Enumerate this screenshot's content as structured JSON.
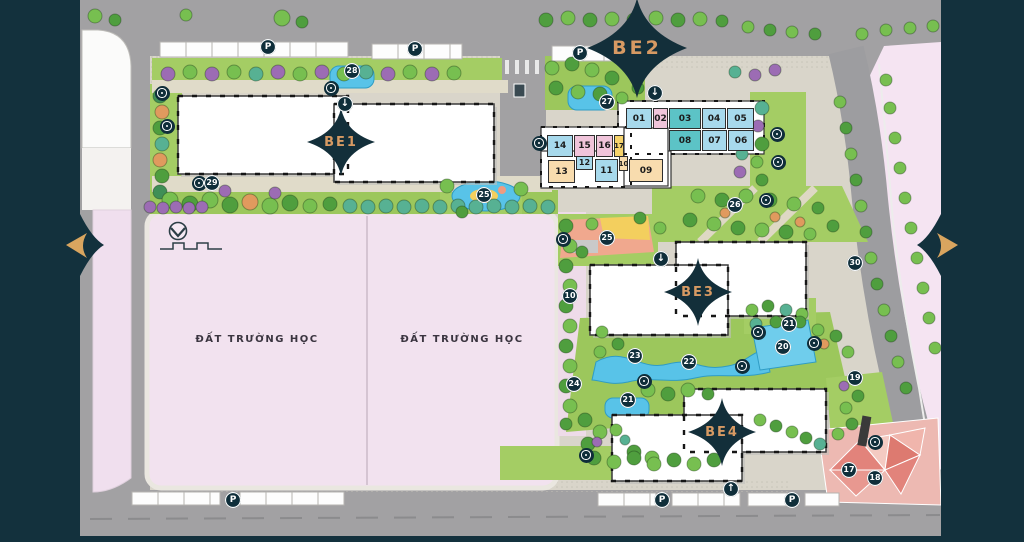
{
  "view": {
    "title": "Master plan site map"
  },
  "map": {
    "zones": [
      {
        "label": "BE1"
      },
      {
        "label": "BE2"
      },
      {
        "label": "BE3"
      },
      {
        "label": "BE4"
      }
    ],
    "school_plots": [
      {
        "label": "ĐẤT TRƯỜNG HỌC"
      },
      {
        "label": "ĐẤT TRƯỜNG HỌC"
      }
    ],
    "units": [
      {
        "label": "01",
        "category": "blue"
      },
      {
        "label": "02",
        "category": "pink"
      },
      {
        "label": "03",
        "category": "teal"
      },
      {
        "label": "04",
        "category": "blue"
      },
      {
        "label": "05",
        "category": "blue"
      },
      {
        "label": "06",
        "category": "blue"
      },
      {
        "label": "07",
        "category": "blue"
      },
      {
        "label": "08",
        "category": "teal"
      },
      {
        "label": "09",
        "category": "tan"
      },
      {
        "label": "10",
        "category": "tan"
      },
      {
        "label": "11",
        "category": "blue"
      },
      {
        "label": "12",
        "category": "blue"
      },
      {
        "label": "13",
        "category": "tan"
      },
      {
        "label": "14",
        "category": "blue"
      },
      {
        "label": "15",
        "category": "pink"
      },
      {
        "label": "16",
        "category": "pink"
      },
      {
        "label": "17",
        "category": "yellow"
      }
    ],
    "amenity_markers": [
      {
        "label": "27"
      },
      {
        "label": "28"
      },
      {
        "label": "29"
      },
      {
        "label": "25"
      },
      {
        "label": "26"
      },
      {
        "label": "25"
      },
      {
        "label": "10"
      },
      {
        "label": "30"
      },
      {
        "label": "21"
      },
      {
        "label": "20"
      },
      {
        "label": "23"
      },
      {
        "label": "22"
      },
      {
        "label": "24"
      },
      {
        "label": "19"
      },
      {
        "label": "21"
      },
      {
        "label": "17"
      },
      {
        "label": "18"
      }
    ],
    "icons": {
      "parking": "P",
      "entrance_down": "↓",
      "entrance_up": "↑"
    },
    "colors": {
      "panel_navy": "#13313d",
      "arrow_gold": "#d9a55f",
      "zone_label": "#d79a63",
      "school_pink": "#f2e2ef",
      "unit_blue": "#a7d9ec",
      "unit_teal": "#5cc3c6",
      "unit_pink": "#f0c4da",
      "unit_yellow": "#f6d36b",
      "unit_tan": "#f8dcae",
      "pool_blue": "#58c3e8",
      "lawn_green": "#a4cd64",
      "plaza_red": "#e2837b"
    }
  }
}
